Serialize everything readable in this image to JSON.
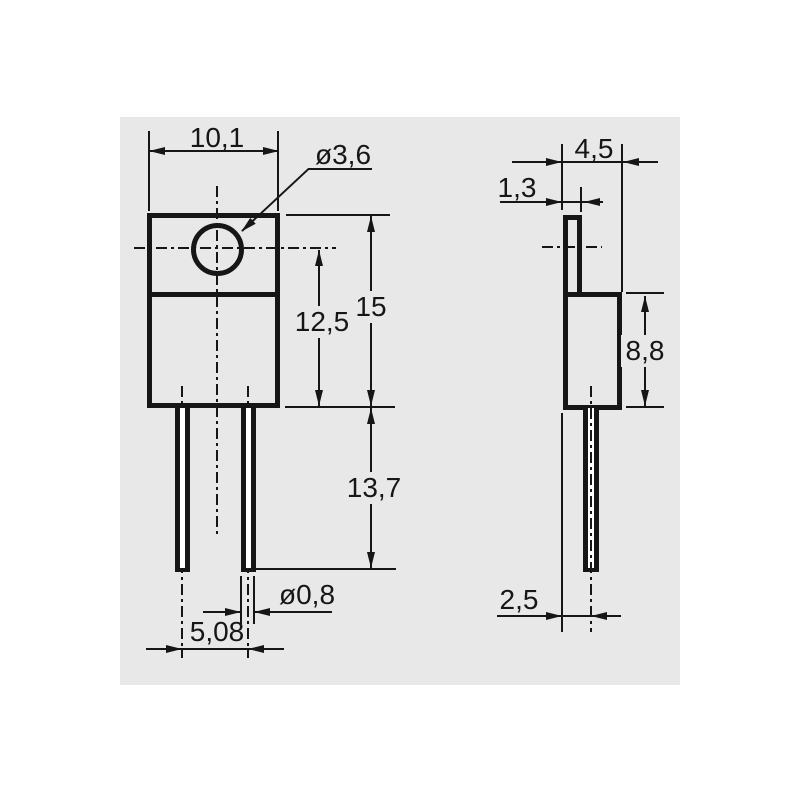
{
  "drawing": {
    "description": "Two-view dimensional drawing of a TO-220 style component",
    "colors": {
      "page_background": "#ffffff",
      "drawing_background": "#e8e8e8",
      "line": "#161616",
      "lead_fill": "#ffffff"
    },
    "front_view": {
      "body_width": "10,1",
      "hole_diameter": "ø3,6",
      "overall_height": "15",
      "hole_center_to_body_bottom": "12,5",
      "lead_length": "13,7",
      "lead_diameter": "ø0,8",
      "lead_pitch": "5,08"
    },
    "side_view": {
      "overall_depth": "4,5",
      "tab_thickness": "1,3",
      "body_height": "8,8",
      "lead_center_offset": "2,5"
    }
  }
}
